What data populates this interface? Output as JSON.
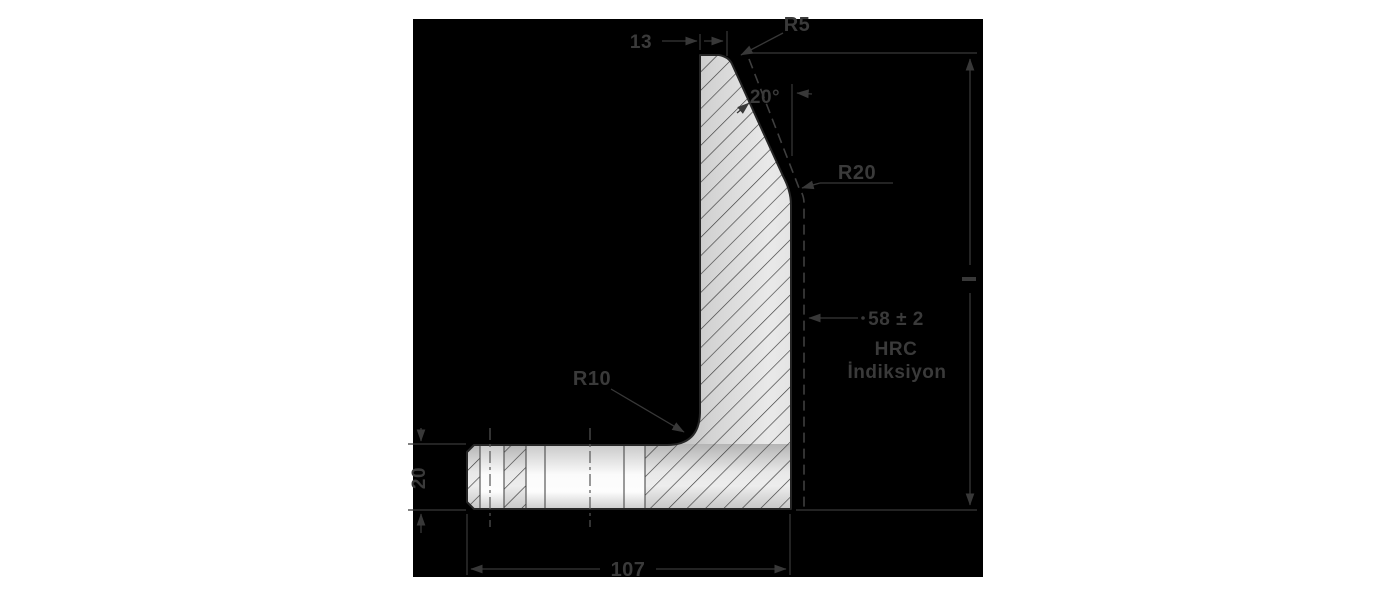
{
  "drawing": {
    "type": "technical-cross-section",
    "canvas": {
      "background": "#000000",
      "page_background": "#ffffff",
      "line_color": "#383838"
    },
    "part": {
      "description": "L-shaped die cross-section, hatched",
      "fill_light": "#ececec",
      "fill_dark": "#a6a6a6"
    },
    "dimensions": {
      "top_width": "13",
      "top_corner_radius": "R5",
      "face_angle": "20°",
      "face_blend_radius": "R20",
      "inner_fillet_radius": "R10",
      "base_thickness": "20",
      "base_width": "107"
    },
    "hardness_note": {
      "line1": "58 ± 2",
      "line2": "HRC",
      "line3": "İndiksiyon"
    }
  }
}
